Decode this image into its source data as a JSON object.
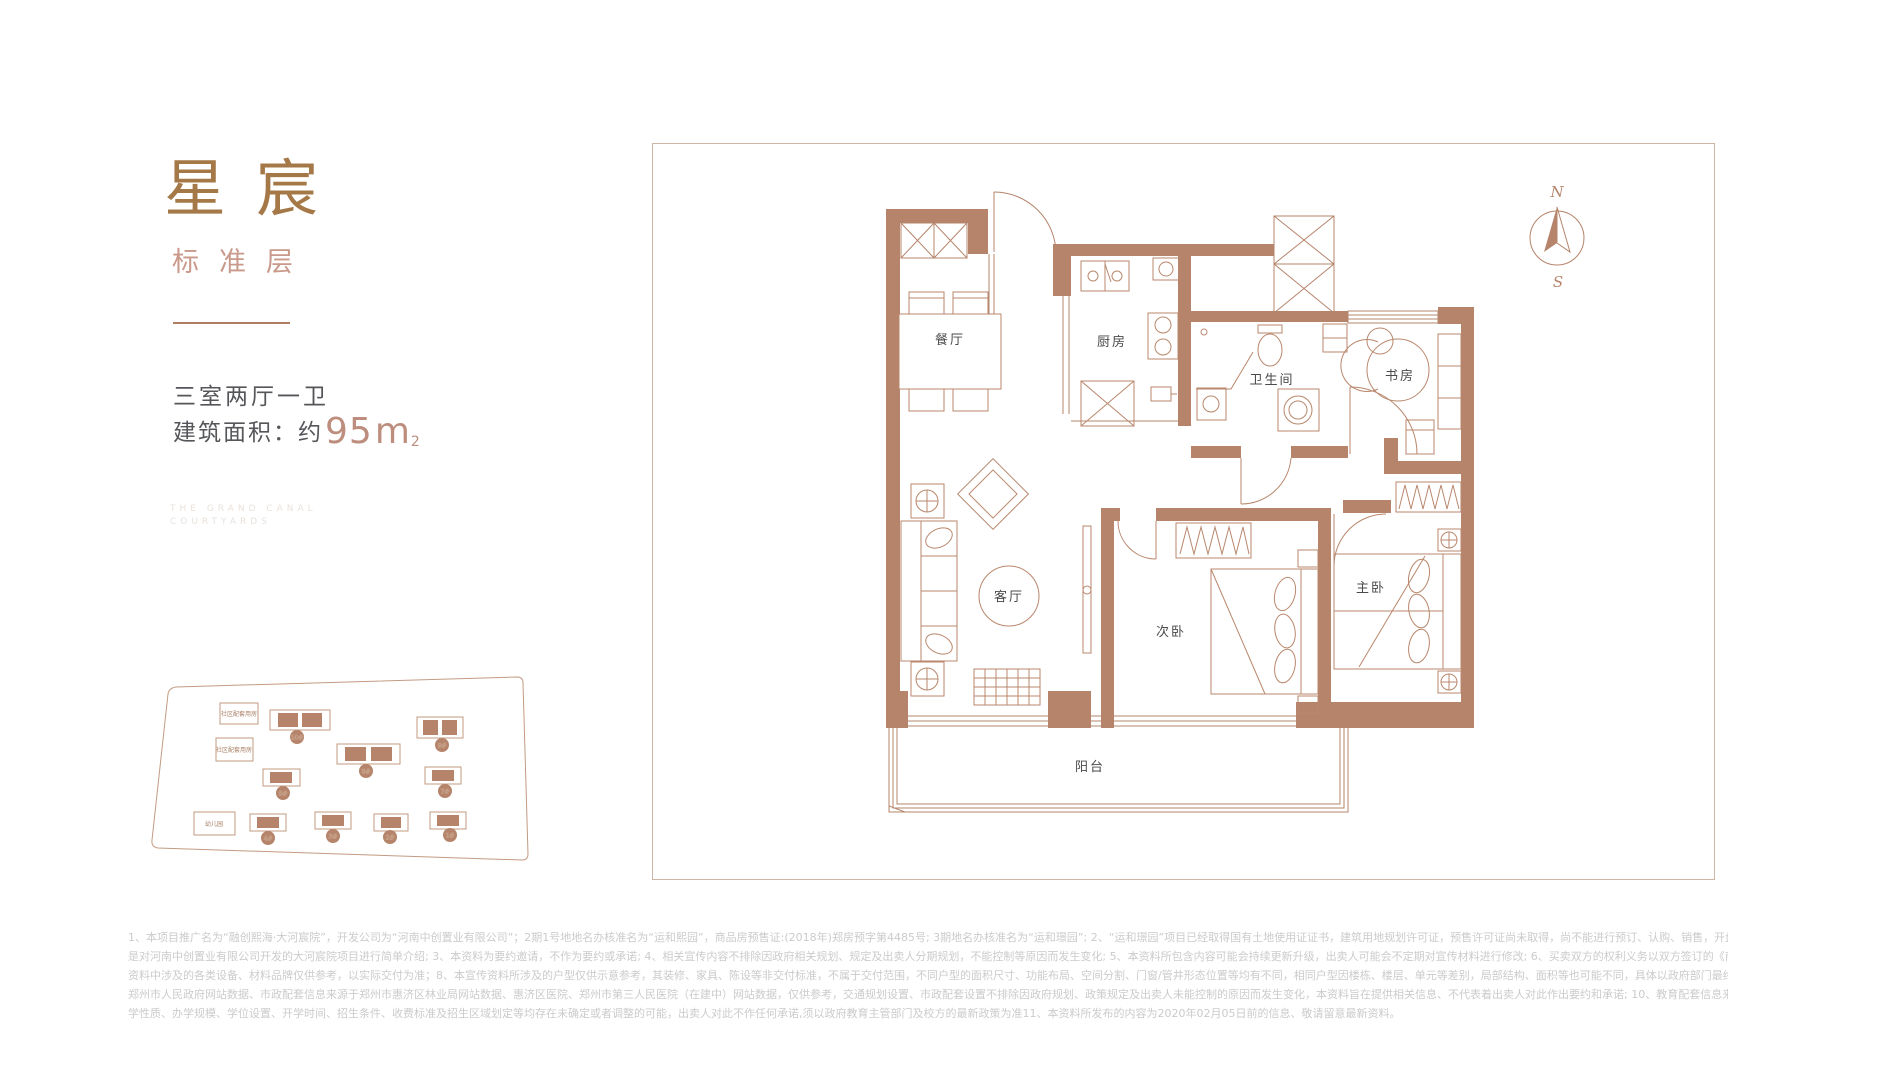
{
  "brand": {
    "title": "星宸",
    "subtitle": "标准层"
  },
  "unit": {
    "layout": "三室两厅一卫",
    "area_label": "建筑面积：约",
    "area_value": "95",
    "area_unit": "m",
    "area_sup": "2"
  },
  "watermark": {
    "line1": "THE GRAND CANAL",
    "line2": "COURTYARDS"
  },
  "siteplan": {
    "facility_labels": [
      "社区配套用房",
      "社区配套用房",
      "幼儿园"
    ],
    "buildings": [
      "10#",
      "9#",
      "8#",
      "6#",
      "7#",
      "4#",
      "3#",
      "2#",
      "1#"
    ]
  },
  "floorplan": {
    "rooms": [
      {
        "label": "餐厅"
      },
      {
        "label": "厨房"
      },
      {
        "label": "卫生间"
      },
      {
        "label": "书房"
      },
      {
        "label": "客厅"
      },
      {
        "label": "次卧"
      },
      {
        "label": "主卧"
      },
      {
        "label": "阳台"
      }
    ],
    "compass": {
      "north": "N",
      "south": "S"
    }
  },
  "colors": {
    "brand_brown": "#a57848",
    "accent_pink": "#c9998b",
    "wall_brown": "#b5846b",
    "text_dark": "#55565a",
    "disclaimer_gray": "#cbcbcb"
  },
  "disclaimer": {
    "lines": [
      "1、本项目推广名为“融创熙海·大河宸院”，开发公司为“河南中创置业有限公司”；2期1号地地名办核准名为“运和熙园”，商品房预售证:(2018年)郑房预字第4485号; 3期地名办核准名为“运和璟园”; 2、“运和璟园”项目已经取得国有土地使用证证书，建筑用地规划许可证，预售许可证尚未取得，尚不能进行预订、认购、销售，开盘前不接受任何形式的预订款、认筹款、购房款等，本广告仅",
      "是对河南中创置业有限公司开发的大河宸院项目进行简单介绍; 3、本资料为要约邀请，不作为要约或承诺; 4、相关宣传内容不排除因政府相关规划、规定及出卖人分期规划，不能控制等原因而发生变化; 5、本资料所包含内容可能会持续更新升级，出卖人可能会不定期对宣传材料进行修改; 6、买卖双方的权利义务以双方签订的《商品房买卖合同》及其补充协议、附件等书面文件为准: 7、",
      "资料中涉及的各类设备、材料品牌仅供参考，以实际交付为准；8、本宣传资料所涉及的户型仅供示意参考，其装修、家具、陈设等非交付标准，不属于交付范围，不同户型的面积尺寸、功能布局、空间分割、门窗/管井形态位置等均有不同，相同户型因楼栋、楼层、单元等差别，局部结构、面积等也可能不同，具体以政府部门最终审定的图纸和销售合同为准: 9.交通配套信息来源于",
      "郑州市人民政府网站数据、市政配套信息来源于郑州市惠济区林业局网站数据、惠济区医院、郑州市第三人民医院（在建中）网站数据，仅供参考，交通规划设置、市政配套设置不排除因政府规划、政策规定及出卖人未能控制的原因而发生变化，本资料旨在提供相关信息、不代表着出卖人对此作出要约和承诺; 10、教育配套信息来源于网络，仅供参考，学校的名称、建成时间、开办",
      "学性质、办学规模、学位设置、开学时间、招生条件、收费标准及招生区域划定等均存在未确定或者调整的可能，出卖人对此不作任何承诺,须以政府教育主管部门及校方的最新政策为准11、本资料所发布的内容为2020年02月05日前的信息、敬请留意最新资料。"
    ]
  }
}
